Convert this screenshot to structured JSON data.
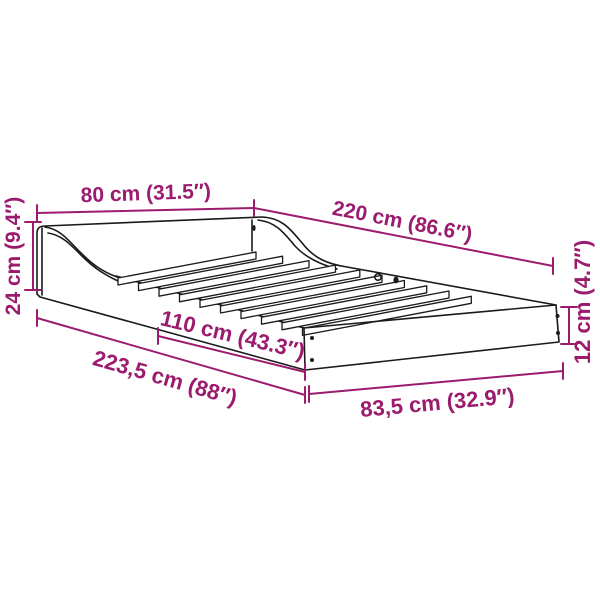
{
  "diagram": {
    "kind": "product-dimension-diagram",
    "subject": "bed-frame-with-wave-headboard",
    "colors": {
      "dimension_accent": "#9B1B6E",
      "line_art": "#1a1a1a",
      "background": "#ffffff"
    },
    "labels": {
      "top_width": "80 cm (31.5″)",
      "back_length": "220 cm (86.6″)",
      "headboard_height": "24 cm (9.4″)",
      "side_section": "110 cm (43.3″)",
      "total_length": "223,5 cm (88″)",
      "foot_section": "83,5 cm (32.9″)",
      "foot_height": "12 cm (4.7″)"
    }
  }
}
